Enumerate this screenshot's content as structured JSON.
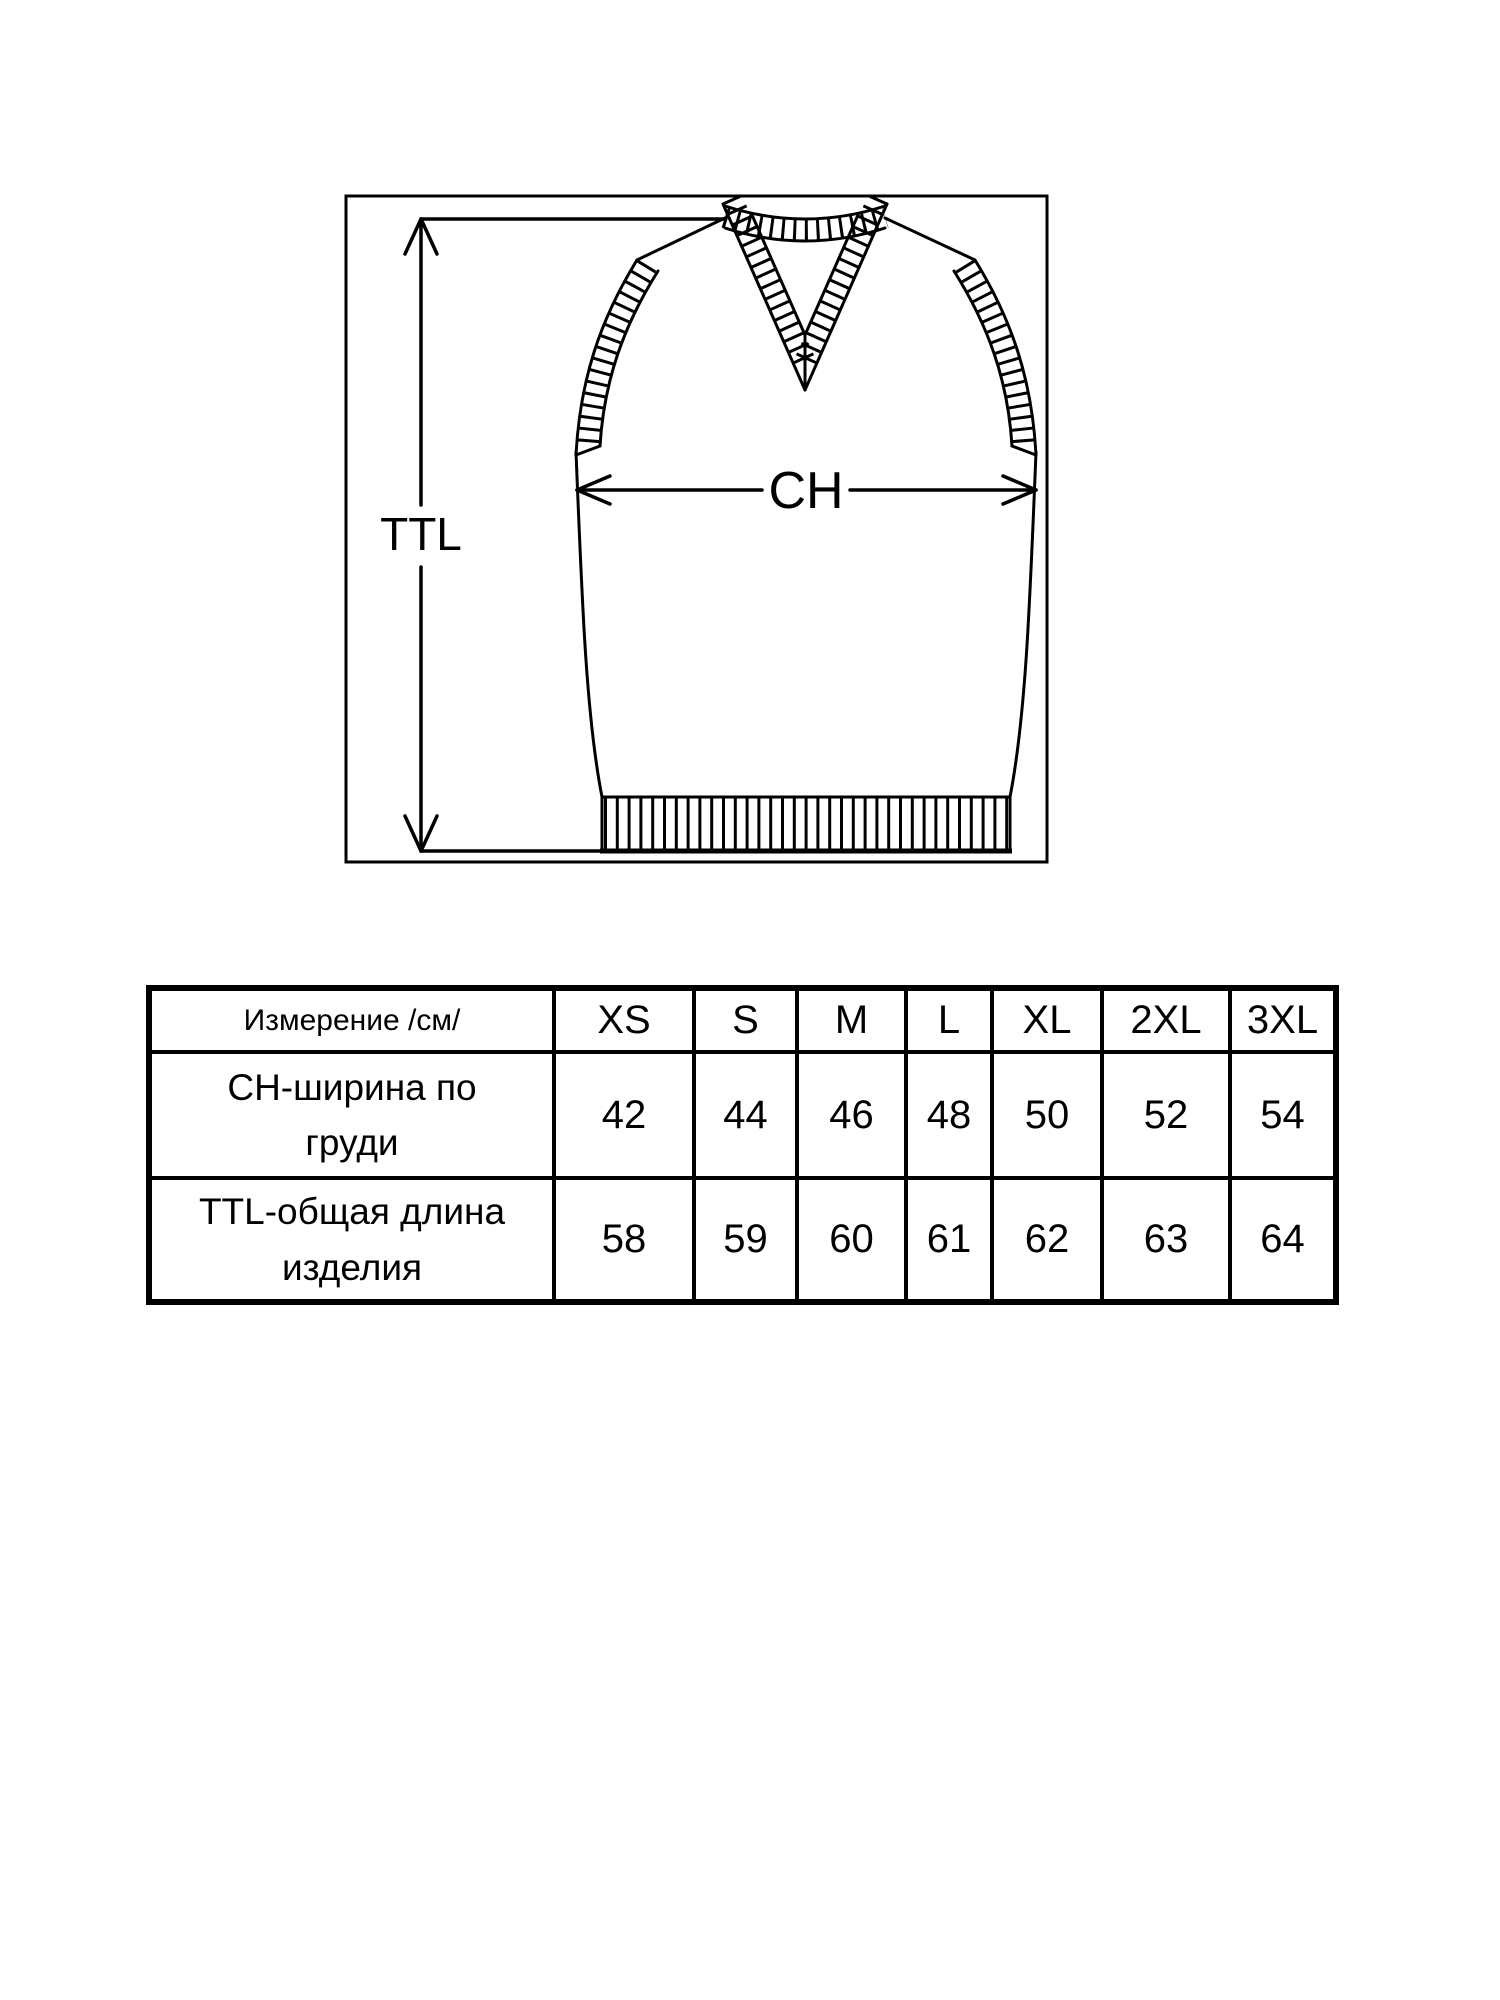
{
  "diagram": {
    "ttl_label": "TTL",
    "ch_label": "CH"
  },
  "size_table": {
    "measurement_header": "Измерение /см/",
    "sizes": [
      "XS",
      "S",
      "M",
      "L",
      "XL",
      "2XL",
      "3XL"
    ],
    "rows": [
      {
        "label": "CH-ширина по\nгруди",
        "values": [
          "42",
          "44",
          "46",
          "48",
          "50",
          "52",
          "54"
        ]
      },
      {
        "label": "TTL-общая длина\nизделия",
        "values": [
          "58",
          "59",
          "60",
          "61",
          "62",
          "63",
          "64"
        ]
      }
    ]
  },
  "colors": {
    "line": "#000000",
    "background": "#ffffff"
  }
}
